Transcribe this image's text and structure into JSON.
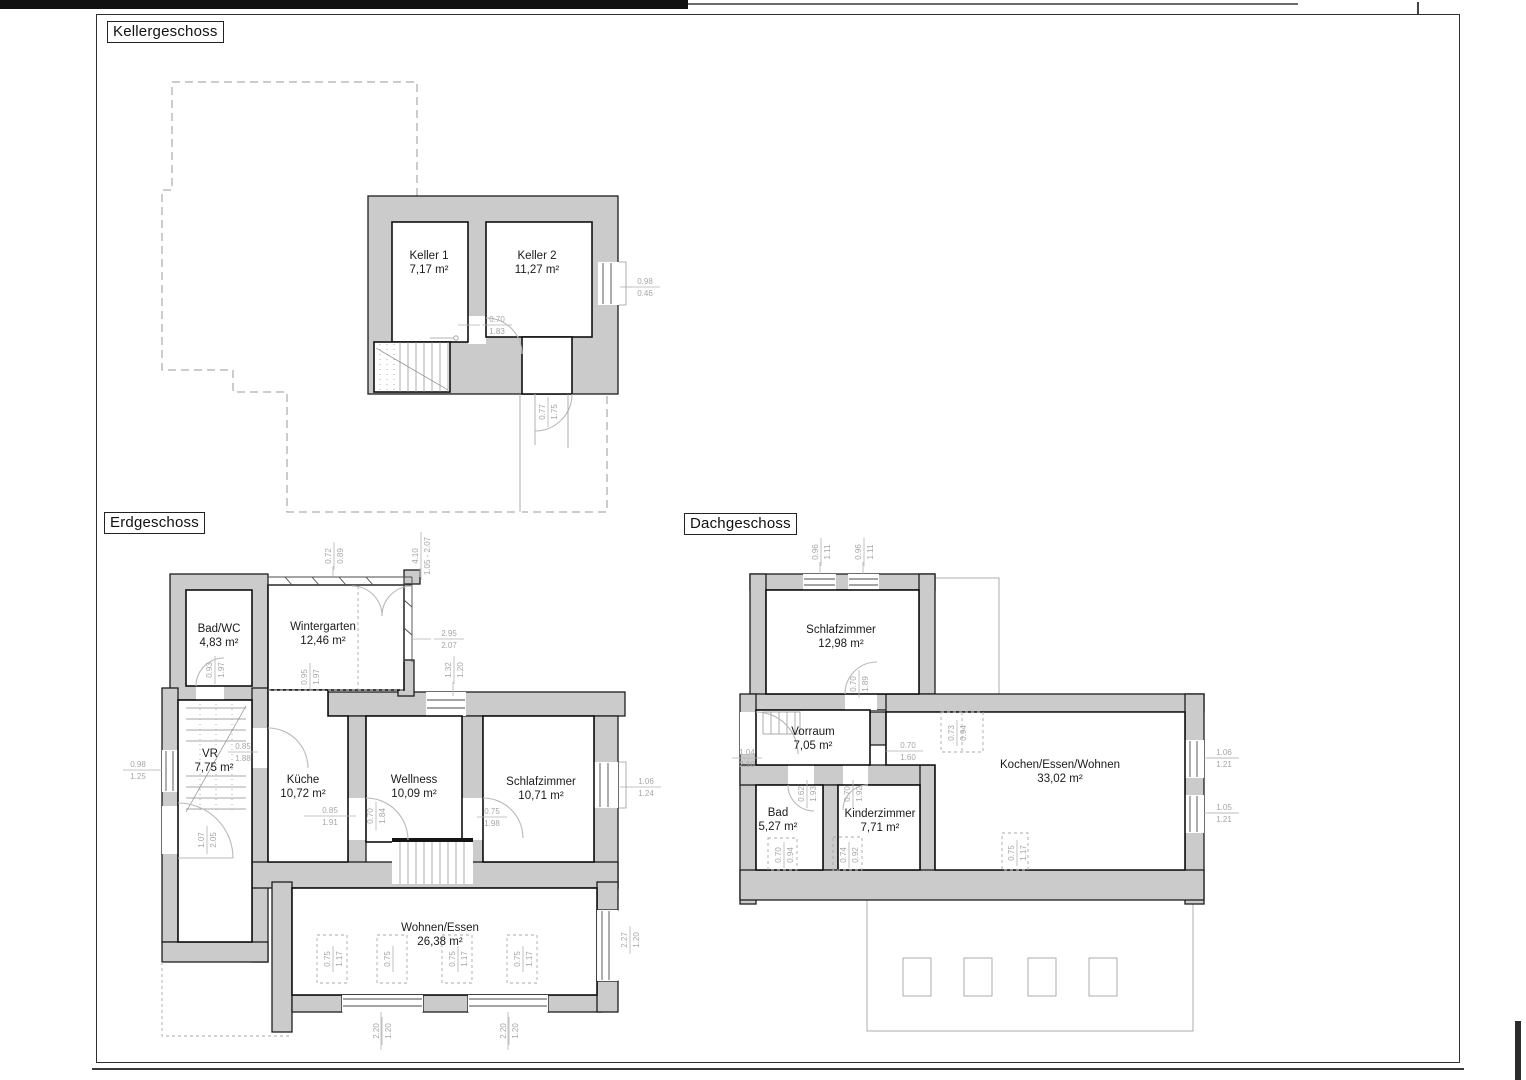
{
  "floors": {
    "kellergeschoss": {
      "title": "Kellergeschoss",
      "rooms": {
        "keller1": {
          "name": "Keller 1",
          "area": "7,17 m²"
        },
        "keller2": {
          "name": "Keller 2",
          "area": "11,27 m²"
        }
      },
      "dims": {
        "door_inner": {
          "w": "0.70",
          "h": "1.83"
        },
        "window_right": {
          "w": "0.98",
          "h": "0.46"
        },
        "door_exit": {
          "w": "0.77",
          "h": "1.75"
        }
      }
    },
    "erdgeschoss": {
      "title": "Erdgeschoss",
      "rooms": {
        "bad_wc": {
          "name": "Bad/WC",
          "area": "4,83 m²"
        },
        "wintergarten": {
          "name": "Wintergarten",
          "area": "12,46 m²"
        },
        "vr": {
          "name": "VR",
          "area": "7,75 m²"
        },
        "kueche": {
          "name": "Küche",
          "area": "10,72 m²"
        },
        "wellness": {
          "name": "Wellness",
          "area": "10,09 m²"
        },
        "schlafzimmer": {
          "name": "Schlafzimmer",
          "area": "10,71 m²"
        },
        "wohnen_essen": {
          "name": "Wohnen/Essen",
          "area": "26,38 m²"
        }
      },
      "dims": {
        "top_left": {
          "w": "0.72",
          "h": "0.89"
        },
        "top_mid": {
          "w": "4.10",
          "h": "1.05 - 2.07"
        },
        "wg_right": {
          "w": "2.95",
          "h": "2.07"
        },
        "win_mid": {
          "w": "1.32",
          "h": "1.20"
        },
        "badwc_door": {
          "w": "0.93",
          "h": "1.97"
        },
        "wg_left": {
          "w": "0.95",
          "h": "1.97"
        },
        "vr_kueche_door": {
          "w": "0.85",
          "h": "1.88"
        },
        "win_left": {
          "w": "0.98",
          "h": "1.25"
        },
        "entry_door": {
          "w": "1.07",
          "h": "2.05"
        },
        "kueche_door": {
          "w": "0.85",
          "h": "1.91"
        },
        "wellness_door": {
          "w": "0.70",
          "h": "1.84"
        },
        "schlaf_door": {
          "w": "0.75",
          "h": "1.98"
        },
        "win_right": {
          "w": "1.06",
          "h": "1.24"
        },
        "sky1": {
          "w": "0.75",
          "h": "1.17"
        },
        "sky2": {
          "w": "0.75",
          "h": "1.17"
        },
        "sky3": {
          "w": "0.75",
          "h": "1.17"
        },
        "sky4": {
          "w": "0.75",
          "h": "1.17"
        },
        "we_right": {
          "w": "2.27",
          "h": "1.20"
        },
        "we_bottom1": {
          "w": "2.20",
          "h": "1.20"
        },
        "we_bottom2": {
          "w": "2.20",
          "h": "1.20"
        }
      }
    },
    "dachgeschoss": {
      "title": "Dachgeschoss",
      "rooms": {
        "schlafzimmer": {
          "name": "Schlafzimmer",
          "area": "12,98 m²"
        },
        "vorraum": {
          "name": "Vorraum",
          "area": "7,05 m²"
        },
        "bad": {
          "name": "Bad",
          "area": "5,27 m²"
        },
        "kinderzimmer": {
          "name": "Kinderzimmer",
          "area": "7,71 m²"
        },
        "kochen_essen_wohnen": {
          "name": "Kochen/Essen/Wohnen",
          "area": "33,02 m²"
        }
      },
      "dims": {
        "roof_win1": {
          "w": "0.96",
          "h": "1.11"
        },
        "roof_win2": {
          "w": "0.96",
          "h": "1.11"
        },
        "schlaf_door": {
          "w": "0.70",
          "h": "1.89"
        },
        "entry_door": {
          "w": "1.04",
          "h": "2.10"
        },
        "kew_door": {
          "w": "0.70",
          "h": "1.60"
        },
        "bad_door": {
          "w": "0.62",
          "h": "1.93"
        },
        "kind_door": {
          "w": "0.70",
          "h": "1.92"
        },
        "sky_top": {
          "w": "0.73",
          "h": "0.94"
        },
        "sky_bad": {
          "w": "0.70",
          "h": "0.94"
        },
        "sky_kind": {
          "w": "0.74",
          "h": "0.92"
        },
        "sky_kew": {
          "w": "0.75",
          "h": "1.17"
        },
        "win_right1": {
          "w": "1.06",
          "h": "1.21"
        },
        "win_right2": {
          "w": "1.05",
          "h": "1.21"
        }
      }
    }
  }
}
